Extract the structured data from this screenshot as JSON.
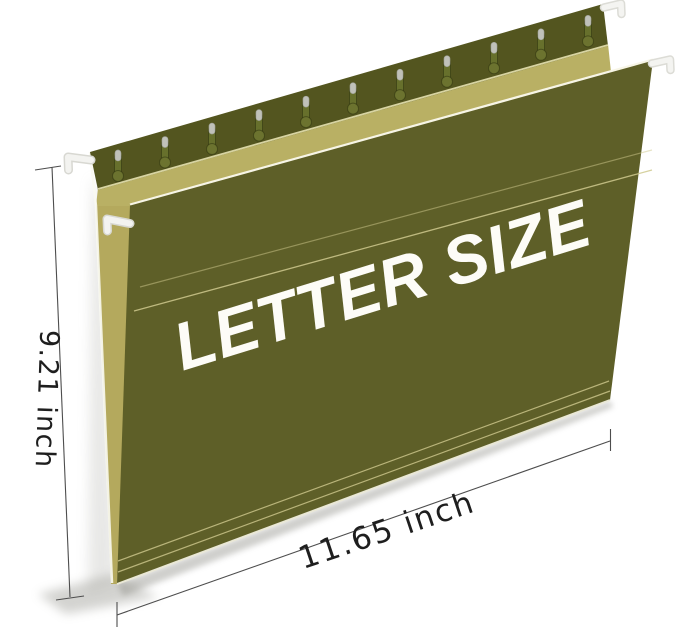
{
  "product_image": {
    "description": "Olive green letter-size hanging file folder with white hanger hooks shown tilted on a white background, annotated with its measurements",
    "folder": {
      "label": "LETTER SIZE",
      "slot_count": 11,
      "hook_count": 4,
      "colors": {
        "front_panel": "#5e5f28",
        "top_band": "#53551f",
        "inner_khaki": "#b9b064",
        "edge_wedge": "#b0a458",
        "slot_body": "#67702c",
        "slot_bulb": "#6c732f",
        "slot_cap": "#c0c1b9",
        "slot_outline": "rgba(35,40,8,0.45)",
        "hook": "#f3f3f0",
        "score_line": "#cfc98e",
        "label_text": "#fdfcf7"
      }
    },
    "dimensions": {
      "height_label": "9.21 inch",
      "width_label": "11.65 inch",
      "line_color": "#4d4d4d"
    }
  }
}
